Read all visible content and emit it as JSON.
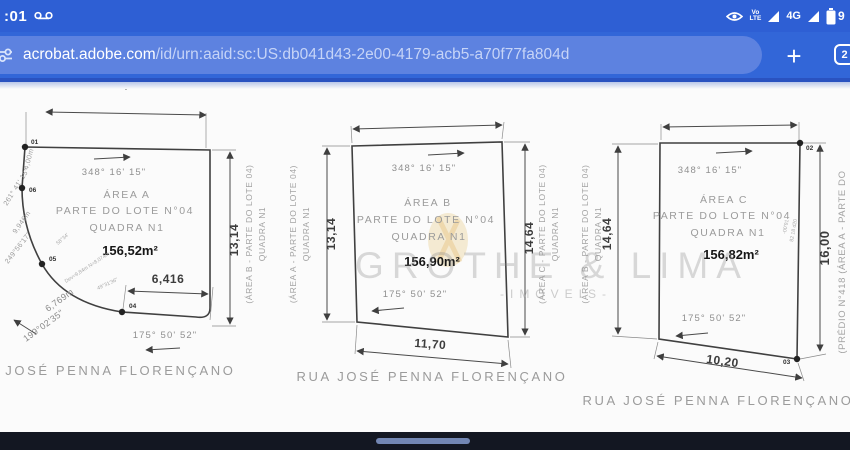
{
  "colors": {
    "statusbar_blue": "#2e5fd4",
    "toolbar_blue": "#3266d8",
    "url_pill_blue": "#5d82e0",
    "toolbar_edge": "#2a52c0",
    "nav_dark": "#131722",
    "nav_pill": "#7286b3",
    "drawing_line": "#404040",
    "faint_text": "#9b9b9b",
    "watermark_gray": "#8c8c8c",
    "logo_tan": "#e8c87e"
  },
  "status_bar": {
    "time": ":01",
    "volte_top": "Vo",
    "volte_bottom": "LTE",
    "network_badge": "4G",
    "battery_digit": "9"
  },
  "url_bar": {
    "domain": "acrobat.adobe.com",
    "path": "/id/urn:aaid:sc:US:db041d43-2e00-4179-acb5-a70f77fa804d",
    "new_tab_label": "+",
    "tab_count": "2"
  },
  "document": {
    "street_name": "RUA JOSÉ PENNA FLORENÇANO",
    "watermark": {
      "title": "GROTHE & LIMA",
      "subtitle": "-IMÓVEIS-"
    },
    "side_labels": {
      "gap_ab": [
        "(ÁREA B - PARTE DO LOTE 04)",
        "QUADRA N1",
        "(ÁREA A - PARTE DO LOTE 04)",
        "QUADRA N1"
      ],
      "gap_bc": [
        "(ÁREA C - PARTE DO LOTE 04)",
        "QUADRA N1",
        "(ÁREA B - PARTE DO LOTE 04)",
        "QUADRA N1"
      ],
      "right_edge": "(PRÉDIO N°418 (ÁREA A - PARTE DO"
    },
    "plots": [
      {
        "name": "ÁREA A",
        "lot": "PARTE DO LOTE N°04",
        "quadra": "QUADRA N1",
        "area": "156,52m²",
        "bearing_top": "348° 16' 15\"",
        "bearing_bottom": "175° 50' 52\"",
        "dim_top": "10,40",
        "dim_right": "13,14",
        "dim_bottom": "6,416",
        "points": [
          "01",
          "06",
          "05",
          "04"
        ],
        "annotations": [
          "4,00m",
          "261° 41' 15\"",
          "9,946m",
          "249°56'17\"",
          "58°34'",
          "Dev=9,84m N=8,074m",
          "49°31'36\"",
          "6,769m",
          "199°02'35\""
        ]
      },
      {
        "name": "ÁREA B",
        "lot": "PARTE DO LOTE N°04",
        "quadra": "QUADRA N1",
        "area": "156,90m²",
        "bearing_top": "348° 16' 15\"",
        "bearing_bottom": "175° 50' 52\"",
        "dim_left": "13,14",
        "dim_right": "14,64",
        "dim_bottom": "11,70"
      },
      {
        "name": "ÁREA C",
        "lot": "PARTE DO LOTE N°04",
        "quadra": "QUADRA N1",
        "area": "156,82m²",
        "bearing_top": "348° 16' 15\"",
        "bearing_bottom": "175° 50' 52\"",
        "dim_left": "14,64",
        "dim_right": "16,00",
        "dim_bottom": "10,20",
        "points": [
          "02",
          "03"
        ],
        "annotations": [
          "-00'91",
          "82 18 d20"
        ]
      }
    ]
  }
}
